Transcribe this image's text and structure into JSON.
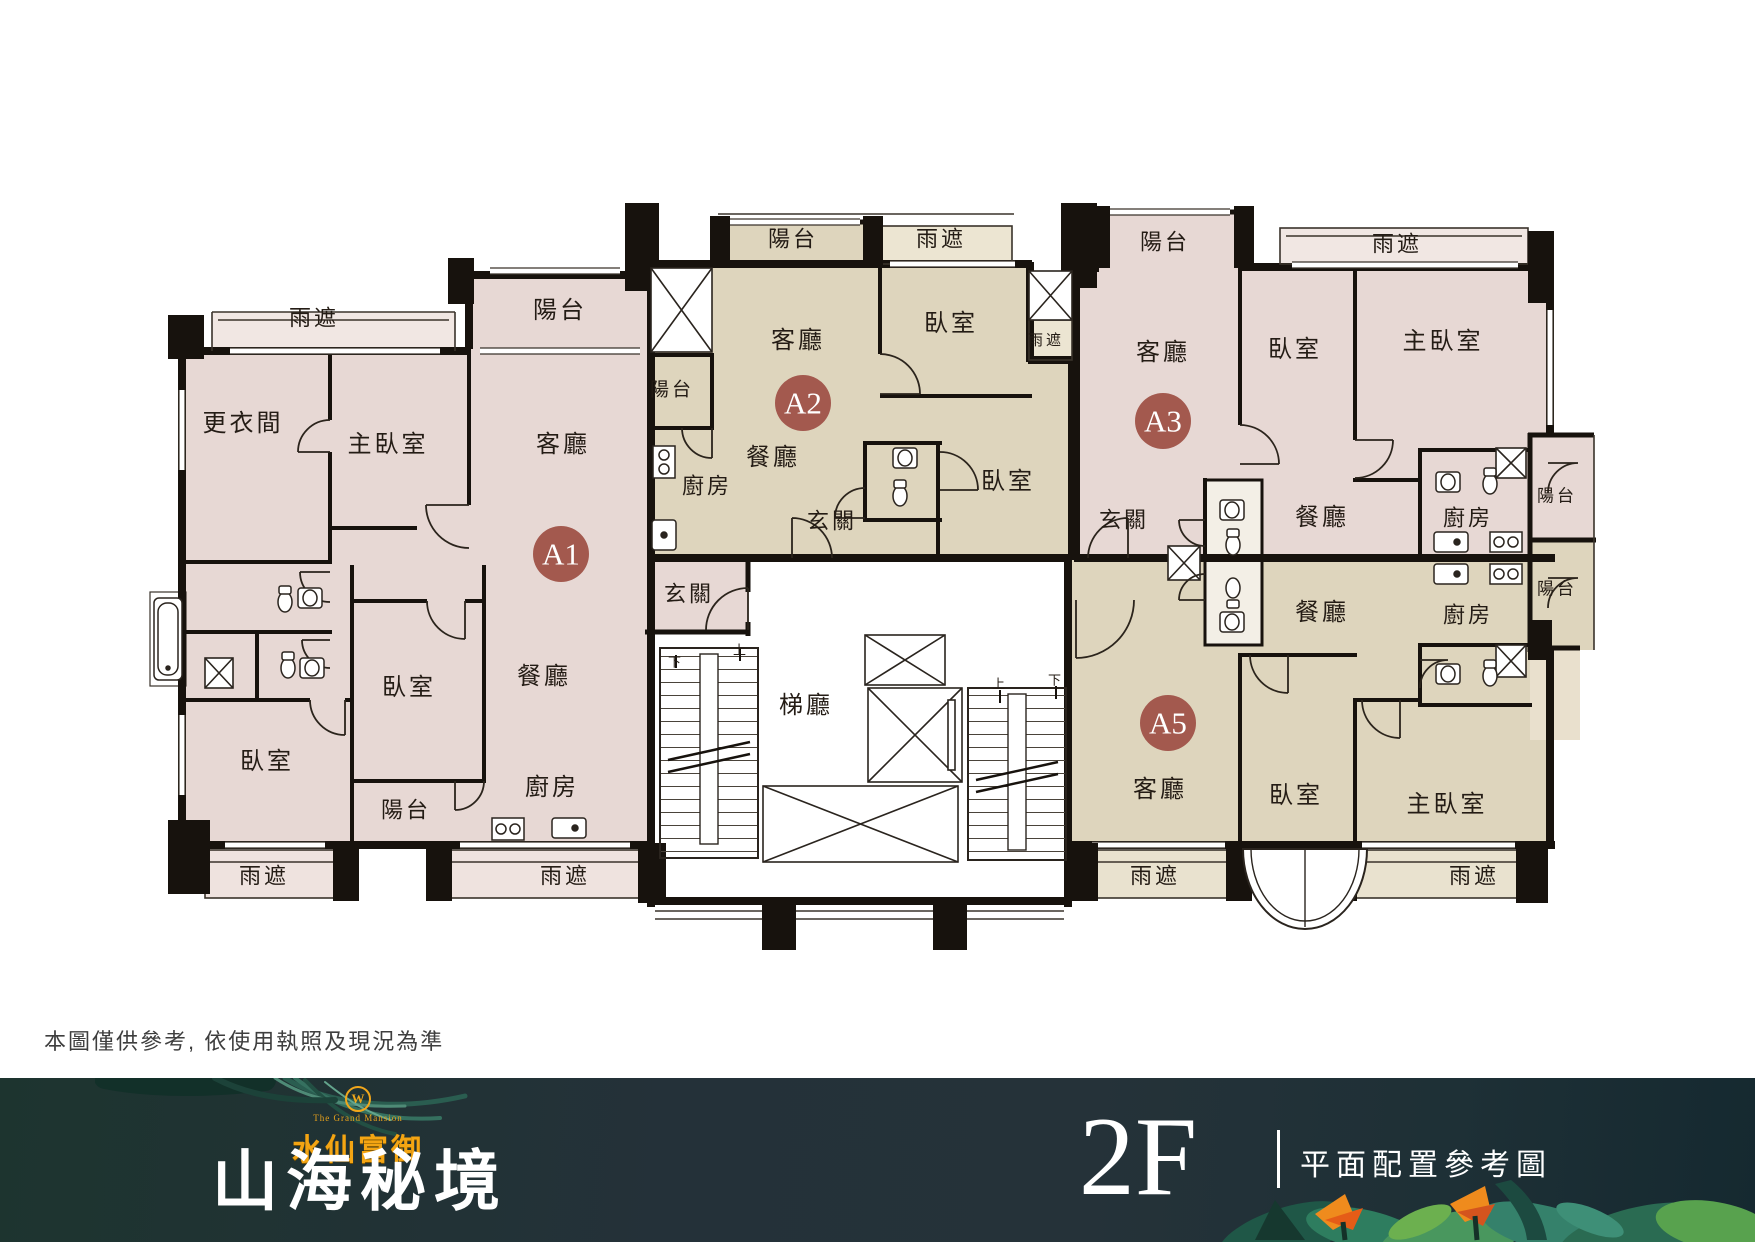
{
  "plan": {
    "disclaimer": "本圖僅供參考, 依使用執照及現況為準",
    "colors": {
      "unit_pink": "#e7d8d4",
      "unit_beige": "#ded5bd",
      "strip_pink": "#f1e7e3",
      "strip_beige": "#ece5d2",
      "wall": "#17120d",
      "marker": "#a3594e",
      "label_text": "#241c15"
    },
    "units": [
      {
        "id": "A1",
        "x": 561,
        "y": 554
      },
      {
        "id": "A2",
        "x": 803,
        "y": 403
      },
      {
        "id": "A3",
        "x": 1163,
        "y": 421
      },
      {
        "id": "A5",
        "x": 1168,
        "y": 723
      }
    ],
    "labels": [
      {
        "t": "雨遮",
        "x": 314,
        "y": 318,
        "s": 22
      },
      {
        "t": "陽台",
        "x": 560,
        "y": 311
      },
      {
        "t": "更衣間",
        "x": 243,
        "y": 424
      },
      {
        "t": "主臥室",
        "x": 388,
        "y": 445
      },
      {
        "t": "客廳",
        "x": 563,
        "y": 445
      },
      {
        "t": "玄關",
        "x": 689,
        "y": 594,
        "s": 22
      },
      {
        "t": "餐廳",
        "x": 544,
        "y": 677
      },
      {
        "t": "臥室",
        "x": 409,
        "y": 688
      },
      {
        "t": "臥室",
        "x": 267,
        "y": 762
      },
      {
        "t": "陽台",
        "x": 406,
        "y": 810,
        "s": 22
      },
      {
        "t": "廚房",
        "x": 552,
        "y": 788
      },
      {
        "t": "雨遮",
        "x": 264,
        "y": 876,
        "s": 22
      },
      {
        "t": "雨遮",
        "x": 565,
        "y": 876,
        "s": 22
      },
      {
        "t": "陽台",
        "x": 793,
        "y": 239,
        "s": 22
      },
      {
        "t": "雨遮",
        "x": 941,
        "y": 239,
        "s": 22
      },
      {
        "t": "客廳",
        "x": 798,
        "y": 341
      },
      {
        "t": "臥室",
        "x": 951,
        "y": 324
      },
      {
        "t": "陽台",
        "x": 672,
        "y": 390,
        "s": 19
      },
      {
        "t": "餐廳",
        "x": 773,
        "y": 458
      },
      {
        "t": "廚房",
        "x": 707,
        "y": 486,
        "s": 22
      },
      {
        "t": "玄關",
        "x": 832,
        "y": 521,
        "s": 22
      },
      {
        "t": "臥室",
        "x": 1008,
        "y": 482
      },
      {
        "t": "雨遮",
        "x": 1046,
        "y": 341,
        "s": 15
      },
      {
        "t": "陽台",
        "x": 1165,
        "y": 242,
        "s": 22
      },
      {
        "t": "雨遮",
        "x": 1397,
        "y": 244,
        "s": 22
      },
      {
        "t": "客廳",
        "x": 1163,
        "y": 353
      },
      {
        "t": "臥室",
        "x": 1295,
        "y": 350
      },
      {
        "t": "主臥室",
        "x": 1443,
        "y": 342
      },
      {
        "t": "玄關",
        "x": 1124,
        "y": 520,
        "s": 22
      },
      {
        "t": "餐廳",
        "x": 1322,
        "y": 518
      },
      {
        "t": "廚房",
        "x": 1468,
        "y": 518,
        "s": 22
      },
      {
        "t": "陽台",
        "x": 1557,
        "y": 496,
        "s": 17
      },
      {
        "t": "餐廳",
        "x": 1322,
        "y": 613
      },
      {
        "t": "廚房",
        "x": 1468,
        "y": 615,
        "s": 22
      },
      {
        "t": "陽台",
        "x": 1557,
        "y": 589,
        "s": 17
      },
      {
        "t": "客廳",
        "x": 1160,
        "y": 790
      },
      {
        "t": "臥室",
        "x": 1296,
        "y": 796
      },
      {
        "t": "主臥室",
        "x": 1447,
        "y": 805
      },
      {
        "t": "雨遮",
        "x": 1155,
        "y": 876,
        "s": 22
      },
      {
        "t": "雨遮",
        "x": 1474,
        "y": 876,
        "s": 22
      },
      {
        "t": "梯廳",
        "x": 806,
        "y": 706
      },
      {
        "t": "上",
        "x": 741,
        "y": 650,
        "s": 13
      },
      {
        "t": "下",
        "x": 676,
        "y": 662,
        "s": 13
      },
      {
        "t": "上",
        "x": 1000,
        "y": 684,
        "s": 13
      },
      {
        "t": "下",
        "x": 1056,
        "y": 680,
        "s": 13
      }
    ]
  },
  "footer": {
    "brand_emblem": "W",
    "brand_en": "The Grand Mansion",
    "brand": "水仙富御",
    "title": "山海秘境",
    "floor": "2F",
    "caption": "平面配置參考圖"
  }
}
